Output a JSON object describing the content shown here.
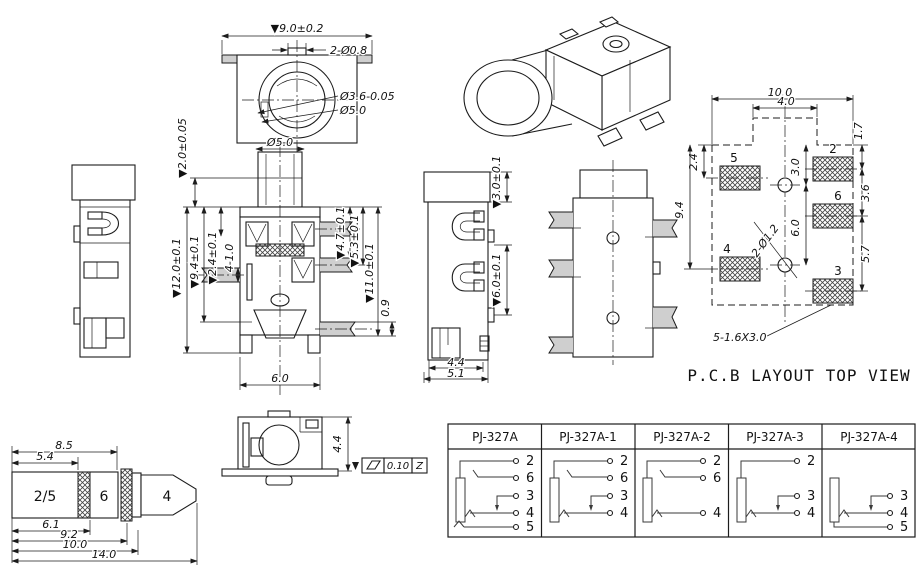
{
  "front_view": {
    "dim_width": "▼9.0±0.2",
    "dim_holes": "2-Ø0.8",
    "dim_inner": "Ø3.6-0.05",
    "dim_outer": "Ø5.0"
  },
  "section_view": {
    "dim_barrel": "Ø5.0",
    "dim_flange": "▼2.0±0.05",
    "dim_total": "▼12.0±0.1",
    "dim_h94": "▼9.4±0.1",
    "dim_h24": "▼2.4±0.1",
    "dim_pins": "4-1.0",
    "dim_r47": "▼4.7±0.1",
    "dim_r53": "▼5.3±0.1",
    "dim_r110": "▼11.0±0.1",
    "dim_r09": "0.9",
    "dim_width": "6.0"
  },
  "side_view": {
    "dim_cap": "▼3.0±0.1",
    "dim_pitch": "▼6.0±0.1",
    "dim_w44": "4.4",
    "dim_w51": "5.1"
  },
  "pcb_layout": {
    "caption": "P.C.B LAYOUT TOP VIEW",
    "dim_w100": "10.0",
    "dim_w40": "4.0",
    "dim_17": "1.7",
    "dim_24": "2.4",
    "dim_94": "9.4",
    "dim_30": "3.0",
    "dim_36": "3.6",
    "dim_60": "6.0",
    "dim_57": "5.7",
    "dim_holes": "2-Ø1.2",
    "dim_pads": "5-1.6X3.0",
    "pad_labels": [
      "5",
      "2",
      "6",
      "4",
      "3"
    ]
  },
  "plug_view": {
    "dim_85": "8.5",
    "dim_54": "5.4",
    "dim_61": "6.1",
    "dim_92": "9.2",
    "dim_100": "10.0",
    "dim_140": "14.0",
    "seg_sleeve": "2/5",
    "seg_ring": "6",
    "seg_tip": "4"
  },
  "rear_view": {
    "dim_h": "4.4",
    "tol_value": "0.10",
    "tol_datum": "Z"
  },
  "variant_table": {
    "columns": [
      {
        "label": "PJ-327A",
        "pins": [
          "2",
          "6",
          "3",
          "4",
          "5"
        ]
      },
      {
        "label": "PJ-327A-1",
        "pins": [
          "2",
          "6",
          "3",
          "4"
        ]
      },
      {
        "label": "PJ-327A-2",
        "pins": [
          "2",
          "6",
          "4"
        ]
      },
      {
        "label": "PJ-327A-3",
        "pins": [
          "2",
          "3",
          "4"
        ]
      },
      {
        "label": "PJ-327A-4",
        "pins": [
          "3",
          "4",
          "5"
        ]
      }
    ]
  }
}
